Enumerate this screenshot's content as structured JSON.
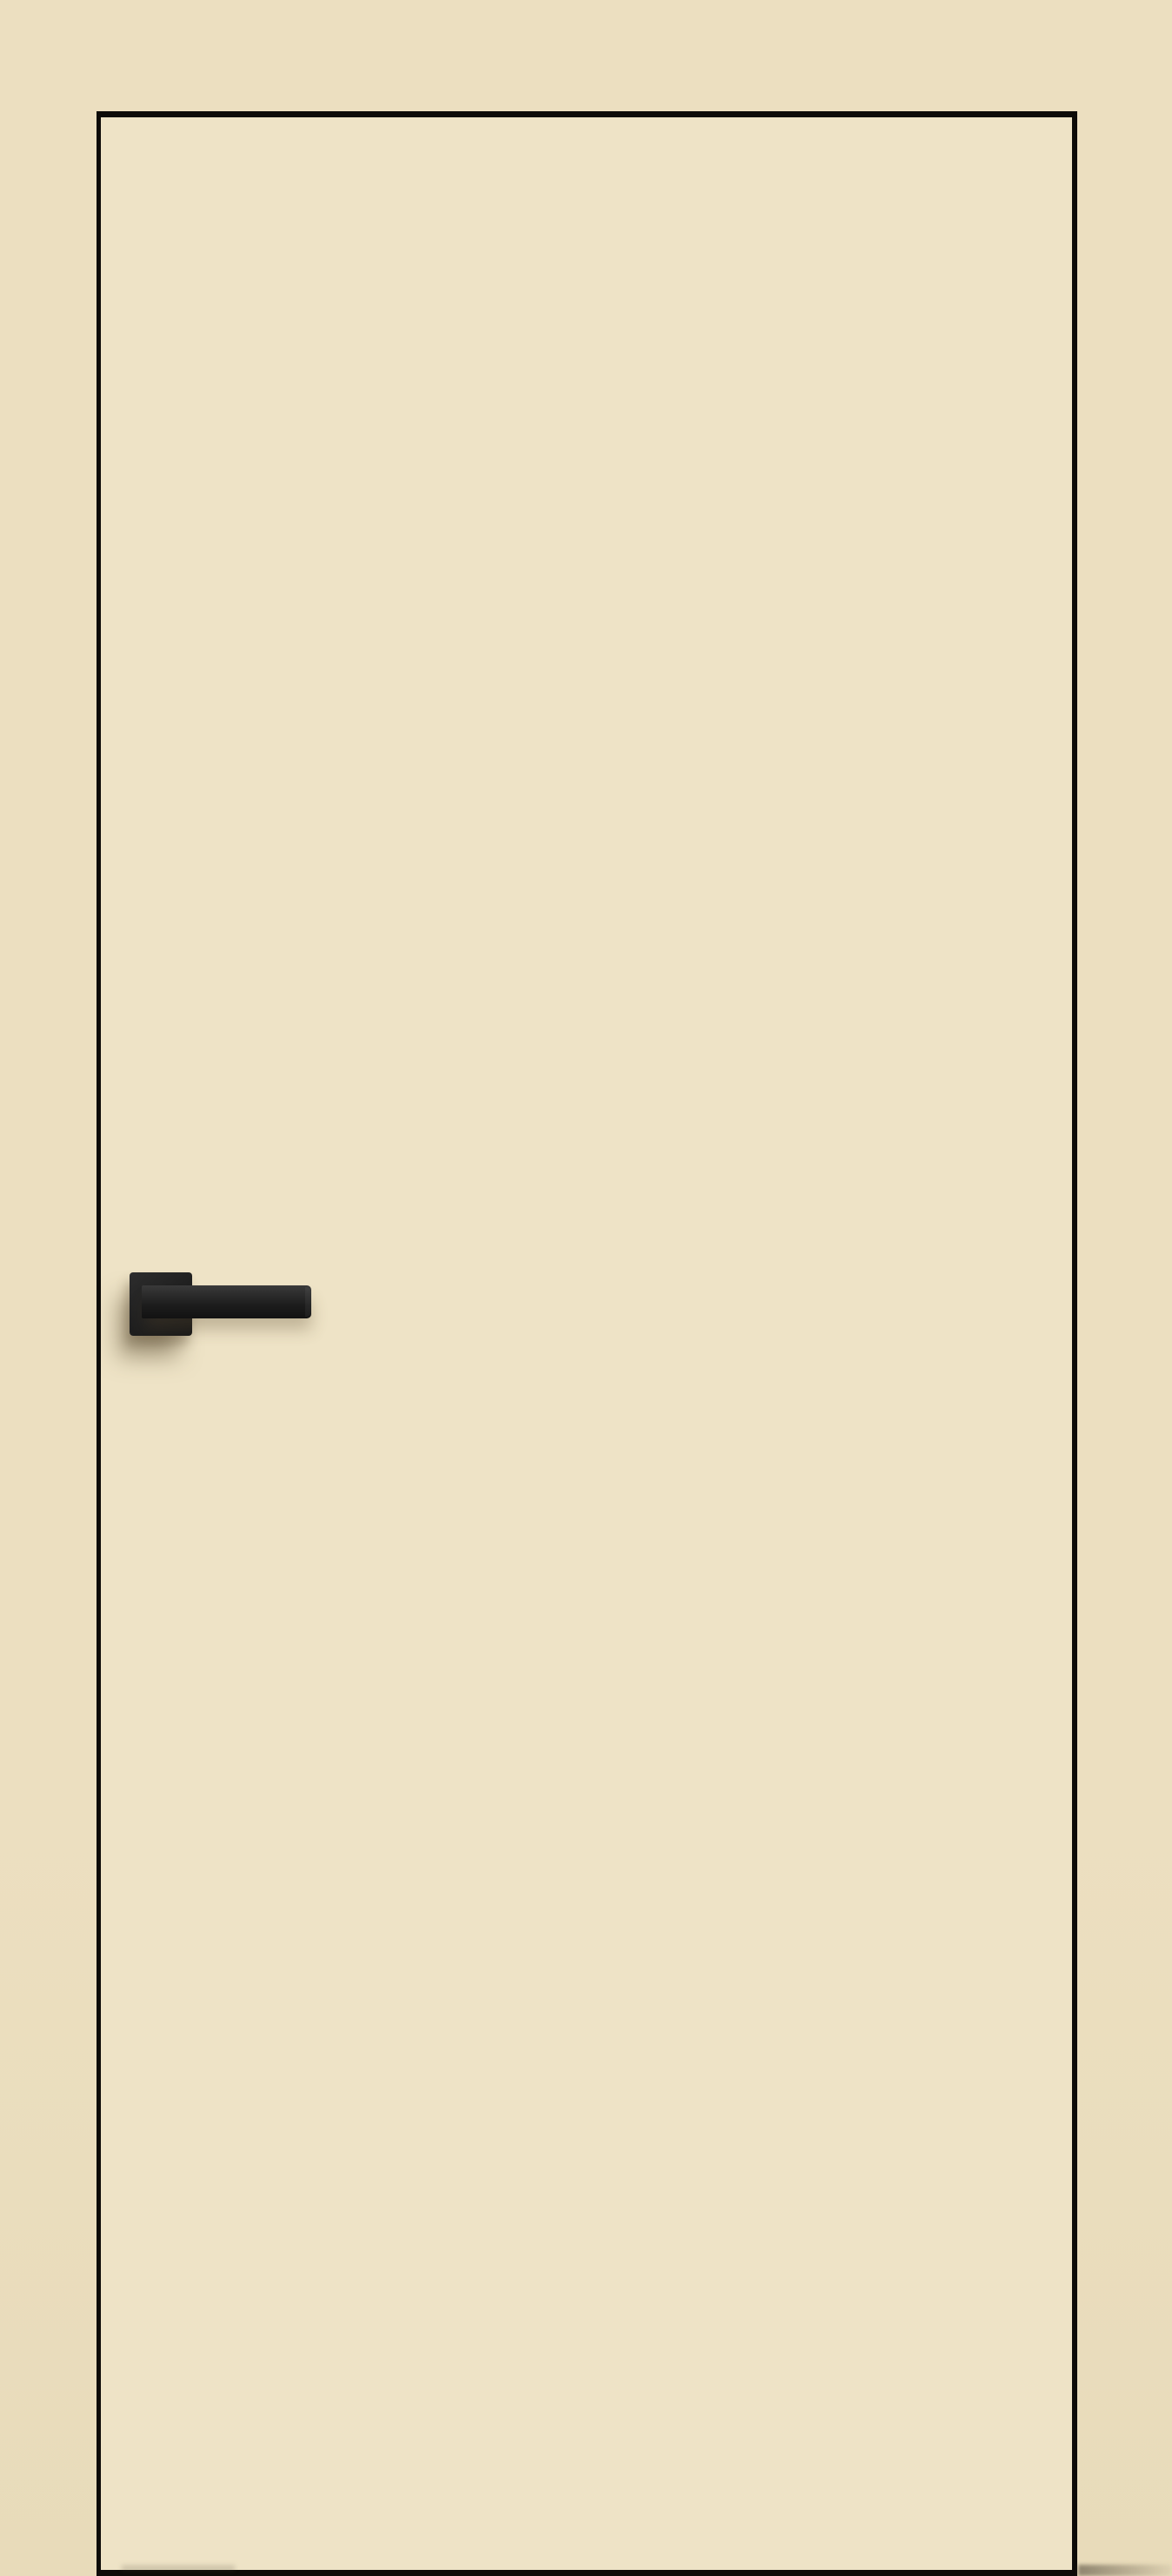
{
  "scene": {
    "type": "product-photo",
    "subject": "Closed flush interior door leaf in cream finish with thin black edge banding and a black square-rosette lever handle, on a matching cream background",
    "text_content": "none",
    "colors": {
      "background": "#ecdfc0",
      "background_deep": "#e8dbba",
      "door_face": "#eee3c6",
      "door_edge": "#0d0b08",
      "handle_base": "#1e1e1e",
      "handle_highlight": "#373737",
      "handle_lowlight": "#101010",
      "shadow": "rgba(88,74,47,0.50)",
      "shadow_soft": "rgba(88,74,47,0.30)"
    }
  },
  "door": {
    "style": "flush slab, no panels, no glazing, no visible hinges",
    "edge": "thin black edge band on all four sides",
    "handle_side": "left",
    "handle": {
      "rosette": "square black rosette",
      "lever": "straight square-profile black lever pointing right"
    }
  }
}
